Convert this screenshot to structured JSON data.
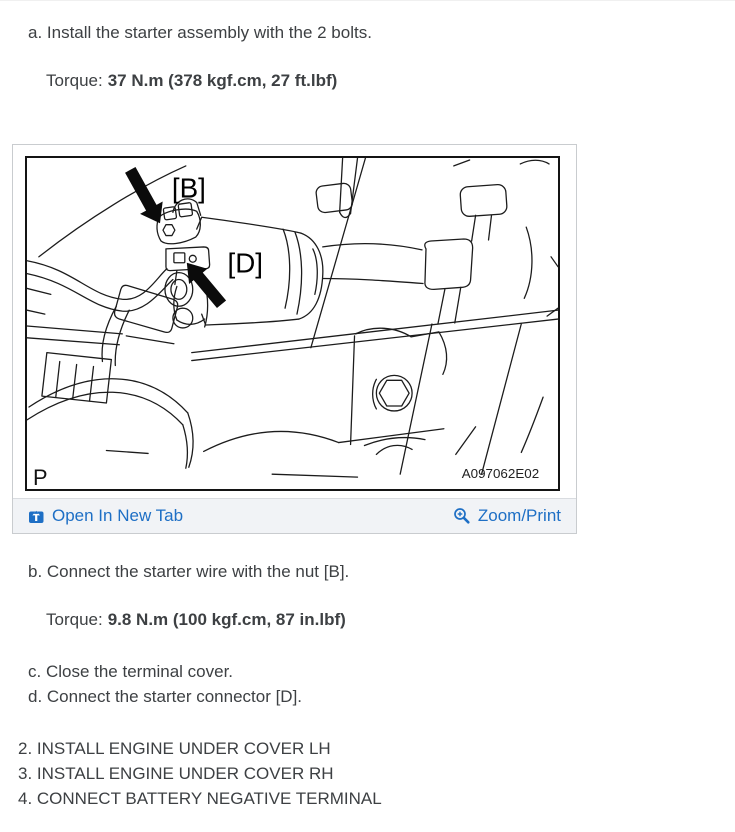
{
  "instructions": {
    "step_a": "a. Install the starter assembly with the 2 bolts.",
    "torque_a": {
      "label": "Torque:",
      "value": "37 N.m (378 kgf.cm, 27 ft.lbf)"
    },
    "step_b": "b. Connect the starter wire with the nut [B].",
    "torque_b": {
      "label": "Torque:",
      "value": "9.8 N.m (100 kgf.cm, 87 in.lbf)"
    },
    "step_c": "c. Close the terminal cover.",
    "step_d": "d. Connect the starter connector [D]."
  },
  "figure": {
    "label_b": "[B]",
    "label_d": "[D]",
    "corner_mark": "P",
    "code": "A097062E02",
    "open_link_label": "Open In New Tab",
    "zoom_link_label": "Zoom/Print"
  },
  "numbered_steps": [
    "2. INSTALL ENGINE UNDER COVER LH",
    "3. INSTALL ENGINE UNDER COVER RH",
    "4. CONNECT BATTERY NEGATIVE TERMINAL"
  ],
  "colors": {
    "link_blue": "#1e6fc5",
    "body_text": "#3d4043",
    "footer_bg": "#f1f3f6",
    "figure_border": "#c9cccf"
  }
}
